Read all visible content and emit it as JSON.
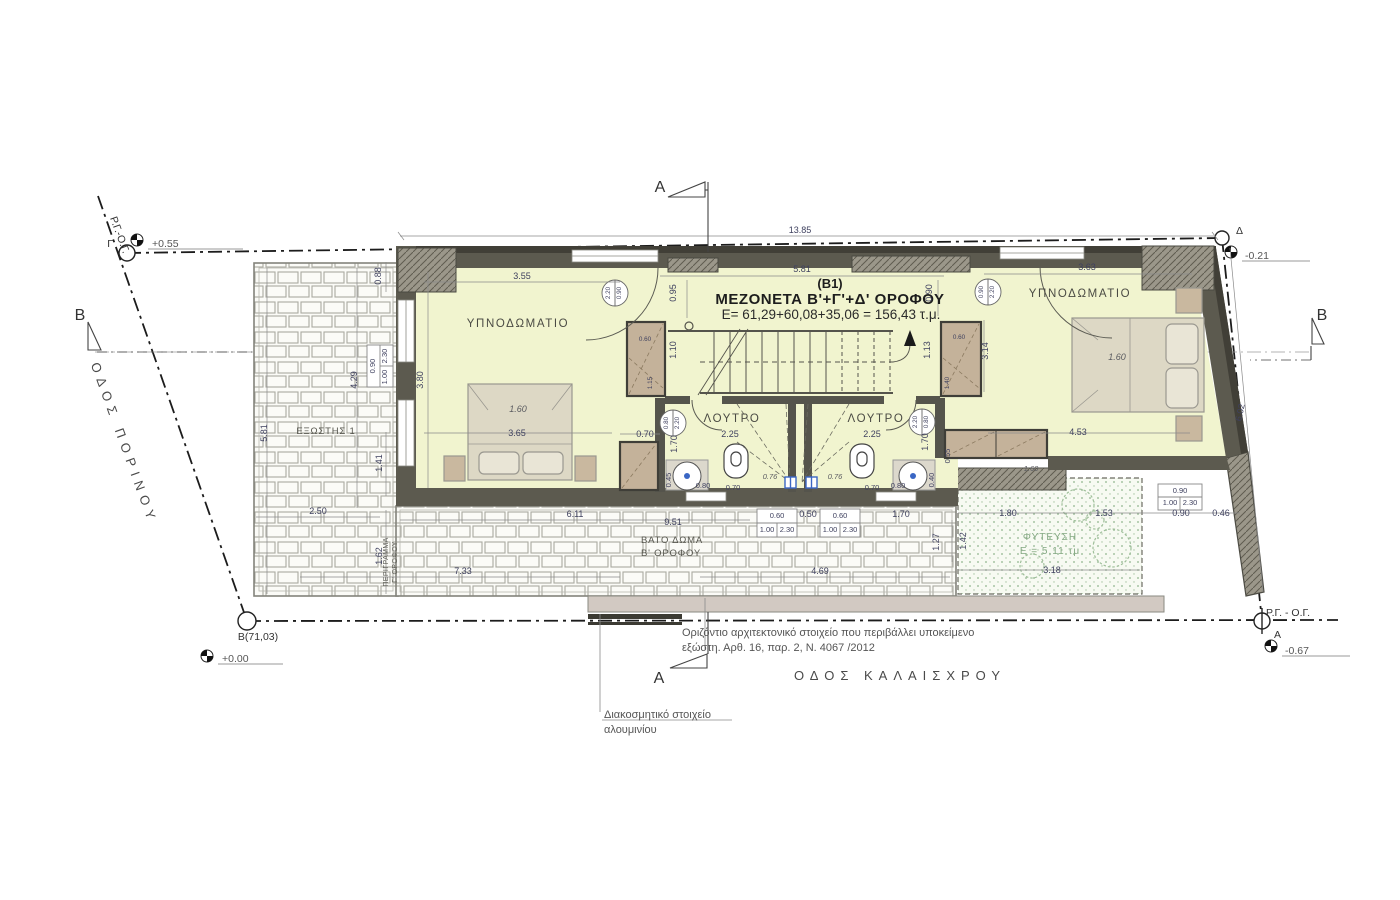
{
  "title": {
    "code": "(B1)",
    "name": "ΜΕΖΟΝΕΤΑ Β'+Γ'+Δ' ΟΡΟΦΟΥ",
    "area": "E= 61,29+60,08+35,06 = 156,43 τ.μ."
  },
  "rooms": {
    "bedroom_left": "ΥΠΝΟΔΩΜΑΤΙΟ",
    "bedroom_right": "ΥΠΝΟΔΩΜΑΤΙΟ",
    "bath_left": "ΛΟΥΤΡΟ",
    "bath_right": "ΛΟΥΤΡΟ",
    "balcony": "ΕΞΩΣΤΗΣ 1",
    "deck_line1": "ΒΑΤΟ ΔΩΜΑ",
    "deck_line2": "Β' ΟΡΟΦΟΥ",
    "plant_line1": "ΦΥΤΕΥΣΗ",
    "plant_line2": "Ε = 5,11 τμ",
    "outline_line1": "ΠΕΡΙΓΡΑΜΜΑ",
    "outline_line2": "Γ' ΟΡΟΦΟΥ"
  },
  "streets": {
    "left": "ΟΔΟΣ ΠΟΡΙΝΟΥ",
    "bottom": "ΟΔΟΣ ΚΑΛΑΙΣΧΡΟΥ"
  },
  "notes": {
    "element_line1": "Οριζόντιο αρχιτεκτονικό στοιχείο που περιβάλλει υποκείμενο",
    "element_line2": "εξώστη. Αρθ. 16, παρ. 2, Ν. 4067 /2012",
    "aluminum_line1": "Διακοσμητικό στοιχείο",
    "aluminum_line2": "αλουμινίου"
  },
  "site": {
    "rg_og_diag": "Ρ.Γ.-Ο.Γ.",
    "rg_og_right": "Ρ.Γ. - Ο.Γ.",
    "points": {
      "gamma": {
        "label": "Γ",
        "level": "+0.55"
      },
      "beta": {
        "label": "Β(71,03)",
        "level": "+0.00"
      },
      "delta": {
        "label": "Δ",
        "level": "-0.21"
      },
      "alpha": {
        "label": "Α",
        "level": "-0.67"
      }
    }
  },
  "sections": {
    "a": "A",
    "b": "B"
  },
  "colors": {
    "interior": "#f1f4cf",
    "wall": "#5c5a4f",
    "wall_dark": "#413f37",
    "furniture": "#c4b29a",
    "bed": "#ddd8c5",
    "plant_dot": "#8fb48c",
    "dim_text": "#3f415f",
    "drain_blue": "#3a66c4"
  },
  "dims": [
    {
      "x": 800,
      "y": 233,
      "t": "13.85"
    },
    {
      "x": 802,
      "y": 272,
      "t": "5.81"
    },
    {
      "x": 522,
      "y": 279,
      "t": "3.55"
    },
    {
      "x": 1087,
      "y": 270,
      "t": "3.63"
    },
    {
      "x": 676,
      "y": 293,
      "t": "0.95",
      "r": -90
    },
    {
      "x": 932,
      "y": 293,
      "t": "0.90",
      "r": -90
    },
    {
      "x": 423,
      "y": 380,
      "t": "3.80",
      "r": -90
    },
    {
      "x": 267,
      "y": 433,
      "t": "5.81",
      "r": -90
    },
    {
      "x": 357,
      "y": 380,
      "t": "4.29",
      "r": -90
    },
    {
      "x": 381,
      "y": 276,
      "t": "0.88",
      "r": -90
    },
    {
      "x": 382,
      "y": 463,
      "t": "1.41",
      "r": -90
    },
    {
      "x": 382,
      "y": 556,
      "t": "1.62",
      "r": -90
    },
    {
      "x": 318,
      "y": 514,
      "t": "2.50"
    },
    {
      "x": 463,
      "y": 574,
      "t": "7.33"
    },
    {
      "x": 575,
      "y": 517,
      "t": "6.11"
    },
    {
      "x": 673,
      "y": 525,
      "t": "9.51"
    },
    {
      "x": 820,
      "y": 574,
      "t": "4.69"
    },
    {
      "x": 939,
      "y": 542,
      "t": "1.27",
      "r": -90
    },
    {
      "x": 676,
      "y": 350,
      "t": "1.10",
      "r": -90
    },
    {
      "x": 930,
      "y": 350,
      "t": "1.13",
      "r": -90
    },
    {
      "x": 988,
      "y": 351,
      "t": "3.14",
      "r": -90
    },
    {
      "x": 518,
      "y": 412,
      "t": "1.60",
      "c": "i"
    },
    {
      "x": 1117,
      "y": 360,
      "t": "1.60",
      "c": "i"
    },
    {
      "x": 517,
      "y": 436,
      "t": "3.65"
    },
    {
      "x": 1078,
      "y": 435,
      "t": "4.53"
    },
    {
      "x": 645,
      "y": 437,
      "t": "0.70"
    },
    {
      "x": 730,
      "y": 437,
      "t": "2.25"
    },
    {
      "x": 872,
      "y": 437,
      "t": "2.25"
    },
    {
      "x": 677,
      "y": 444,
      "t": "1.70",
      "r": -90
    },
    {
      "x": 928,
      "y": 442,
      "t": "1.70",
      "r": -90
    },
    {
      "x": 770,
      "y": 479,
      "t": "0.76",
      "c": "i s"
    },
    {
      "x": 835,
      "y": 479,
      "t": "0.76",
      "c": "i s"
    },
    {
      "x": 733,
      "y": 490,
      "t": "0.70",
      "c": "s"
    },
    {
      "x": 872,
      "y": 490,
      "t": "0.70",
      "c": "s"
    },
    {
      "x": 703,
      "y": 488,
      "t": "0.80",
      "c": "s"
    },
    {
      "x": 898,
      "y": 488,
      "t": "0.80",
      "c": "s"
    },
    {
      "x": 671,
      "y": 480,
      "t": "0.45",
      "r": -90,
      "c": "s"
    },
    {
      "x": 934,
      "y": 480,
      "t": "0.40",
      "r": -90,
      "c": "s"
    },
    {
      "x": 950,
      "y": 456,
      "t": "0.55",
      "r": -90,
      "c": "s"
    },
    {
      "x": 1031,
      "y": 471,
      "t": "1.60",
      "c": "i s"
    },
    {
      "x": 808,
      "y": 517,
      "t": "0.50"
    },
    {
      "x": 901,
      "y": 517,
      "t": "1.70"
    },
    {
      "x": 777,
      "y": 518,
      "t": "0.60",
      "c": "s"
    },
    {
      "x": 767,
      "y": 532,
      "t": "1.00",
      "c": "s"
    },
    {
      "x": 787,
      "y": 532,
      "t": "2.30",
      "c": "s"
    },
    {
      "x": 840,
      "y": 518,
      "t": "0.60",
      "c": "s"
    },
    {
      "x": 830,
      "y": 532,
      "t": "1.00",
      "c": "s"
    },
    {
      "x": 850,
      "y": 532,
      "t": "2.30",
      "c": "s"
    },
    {
      "x": 1180,
      "y": 493,
      "t": "0.90",
      "c": "s"
    },
    {
      "x": 1170,
      "y": 505,
      "t": "1.00",
      "c": "s"
    },
    {
      "x": 1190,
      "y": 505,
      "t": "2.30",
      "c": "s"
    },
    {
      "x": 1008,
      "y": 516,
      "t": "1.80"
    },
    {
      "x": 1104,
      "y": 516,
      "t": "1.53"
    },
    {
      "x": 1181,
      "y": 516,
      "t": "0.90"
    },
    {
      "x": 1221,
      "y": 516,
      "t": "0.46"
    },
    {
      "x": 966,
      "y": 541,
      "t": "1.42",
      "r": -90
    },
    {
      "x": 1052,
      "y": 573,
      "t": "3.18"
    },
    {
      "x": 1243,
      "y": 413,
      "t": "6.02",
      "r": -78
    },
    {
      "x": 375,
      "y": 366,
      "t": "0.90",
      "r": -90,
      "c": "s"
    },
    {
      "x": 387,
      "y": 377,
      "t": "1.00",
      "r": -90,
      "c": "s"
    },
    {
      "x": 387,
      "y": 356,
      "t": "2.30",
      "r": -90,
      "c": "s"
    },
    {
      "x": 645,
      "y": 341,
      "t": "0.60",
      "c": "t"
    },
    {
      "x": 652,
      "y": 383,
      "t": "1.15",
      "r": -90,
      "c": "t"
    },
    {
      "x": 959,
      "y": 339,
      "t": "0.60",
      "c": "t"
    },
    {
      "x": 949,
      "y": 383,
      "t": "1.40",
      "r": -90,
      "c": "t"
    },
    {
      "x": 610,
      "y": 293,
      "t": "2.20",
      "r": -90,
      "c": "t"
    },
    {
      "x": 621,
      "y": 293,
      "t": "0.90",
      "r": -90,
      "c": "t"
    },
    {
      "x": 983,
      "y": 292,
      "t": "0.90",
      "r": -90,
      "c": "t"
    },
    {
      "x": 994,
      "y": 292,
      "t": "2.20",
      "r": -90,
      "c": "t"
    },
    {
      "x": 668,
      "y": 423,
      "t": "0.80",
      "r": -90,
      "c": "t"
    },
    {
      "x": 679,
      "y": 423,
      "t": "2.20",
      "r": -90,
      "c": "t"
    },
    {
      "x": 917,
      "y": 422,
      "t": "2.20",
      "r": -90,
      "c": "t"
    },
    {
      "x": 928,
      "y": 422,
      "t": "0.80",
      "r": -90,
      "c": "t"
    }
  ]
}
